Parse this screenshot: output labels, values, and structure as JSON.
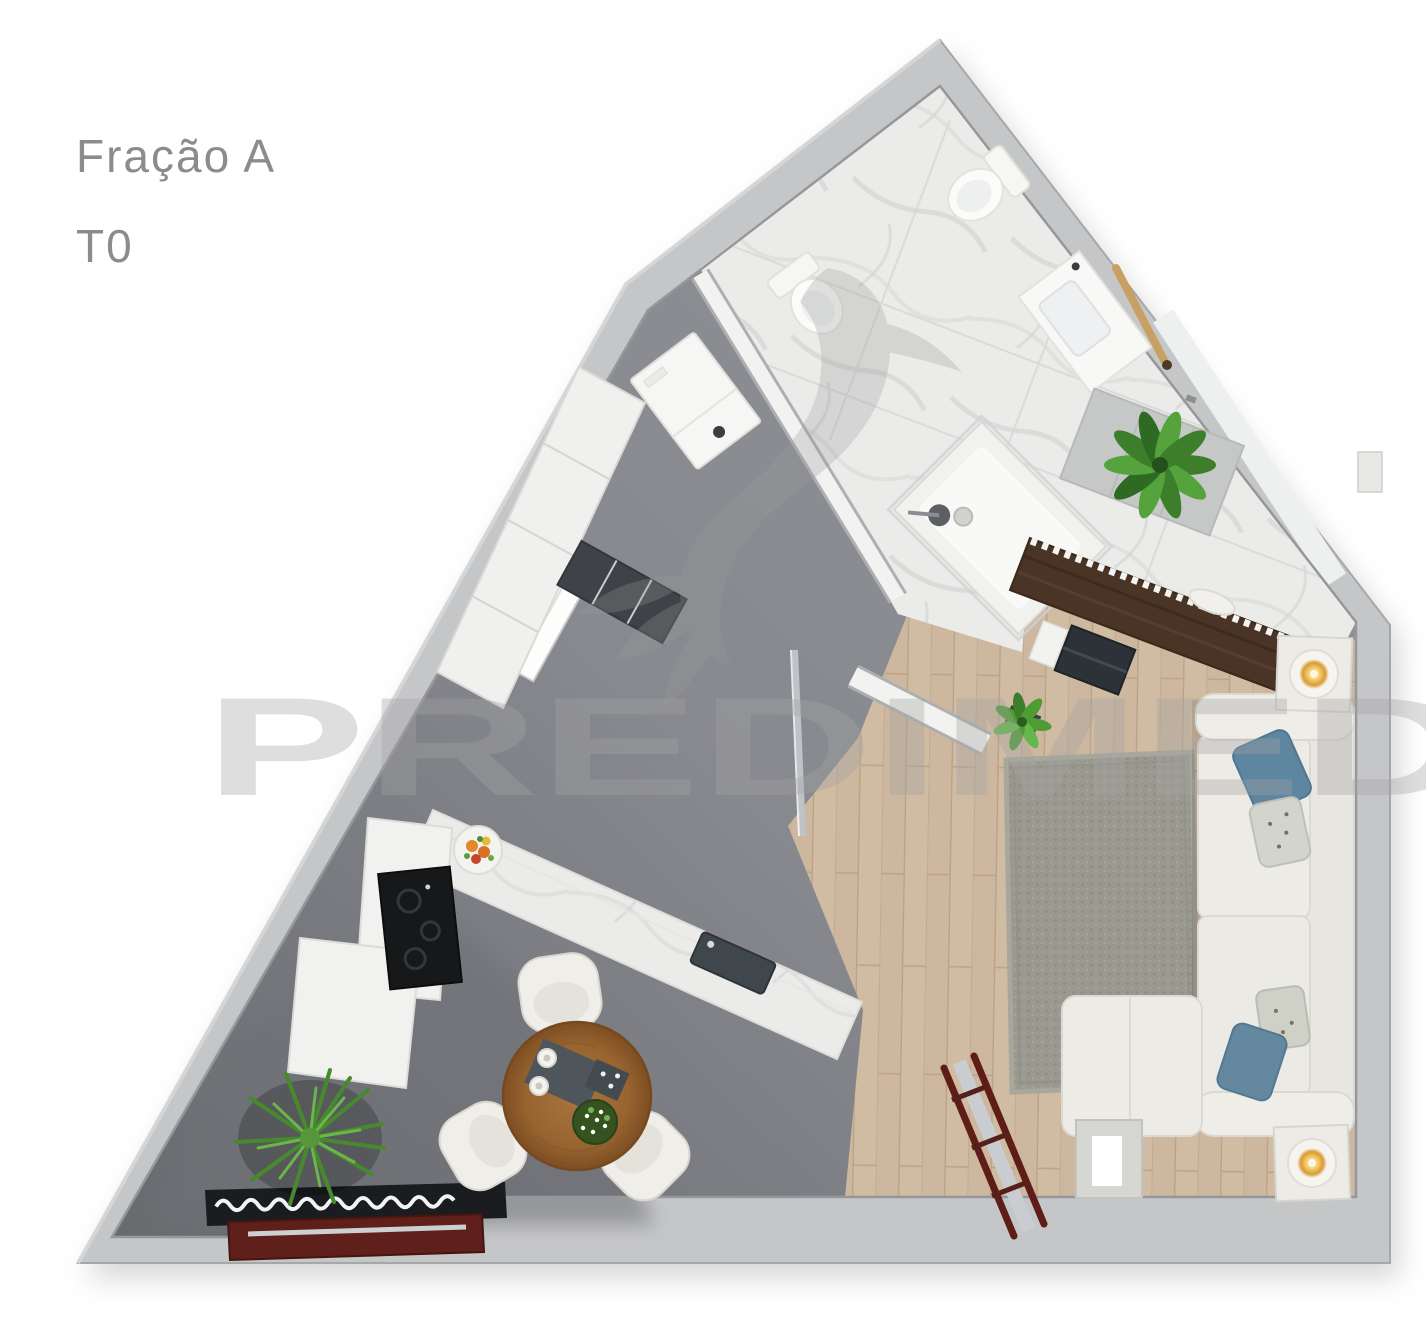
{
  "page": {
    "width": 1426,
    "height": 1318,
    "background": "#ffffff"
  },
  "header": {
    "title": "Fração A",
    "subtitle": "T0",
    "text_color": "#8b8c8e"
  },
  "watermark": {
    "text": "PREDIMED",
    "logo": "hummingbird-logo",
    "color": "#a3a3a3",
    "opacity": "0.36"
  },
  "plan": {
    "unit_label": "Fração A",
    "typology": "T0",
    "wall_color": "#c5c6c8",
    "wall_edge_color": "#a6a7a9",
    "floor_colors": {
      "hallway": "#8d8f95",
      "kitchen_shade": "#6f7176",
      "bathroom_marble": "#ebecea",
      "living_wood": "#cdb79f",
      "shower_bench_tile": "#c6c8c7"
    },
    "accent_colors": {
      "sofa": "#edebe5",
      "rug": "#9a998f",
      "pillow_blue": "#5f86a0",
      "pillow_patterned": "#d3d4cb",
      "sideboard_wood": "#4a3426",
      "zigzag_trim": "#f4f4f2",
      "dining_table_wood": "#97632f",
      "chair": "#efeee8",
      "kitchen_counter": "#f1f1ef",
      "cooktop": "#17181a",
      "plant_green": "#4c8f33",
      "candle_glow": "#f3cc6e",
      "ladder_red": "#5f1d18",
      "cabinet_red": "#5f1f1a",
      "media_shelf_black": "#1a1c1f",
      "door_chrome": "#bfc3c7",
      "towel_rail_wood": "#c8a063"
    },
    "rooms": [
      "bathroom",
      "hallway",
      "kitchen",
      "dining-area",
      "living-room"
    ],
    "furniture": [
      "toilet",
      "bidet",
      "washbasin-vanity",
      "towel-rail",
      "shower",
      "shower-bench-plant",
      "washing-machine",
      "wardrobe",
      "shelf-niche",
      "window",
      "sliding-glass-door",
      "entry-door",
      "kitchen-counter",
      "cooktop",
      "kitchen-sink",
      "fruit-bowl",
      "dining-table",
      "dining-chair",
      "potted-fern",
      "media-shelf",
      "red-cabinet",
      "sideboard",
      "vase",
      "laptop",
      "potted-plant",
      "area-rug",
      "sofa",
      "chaise-lounge",
      "cushion",
      "side-table-candle",
      "decorative-ladder",
      "pedestal-stand",
      "wall-vent"
    ]
  }
}
